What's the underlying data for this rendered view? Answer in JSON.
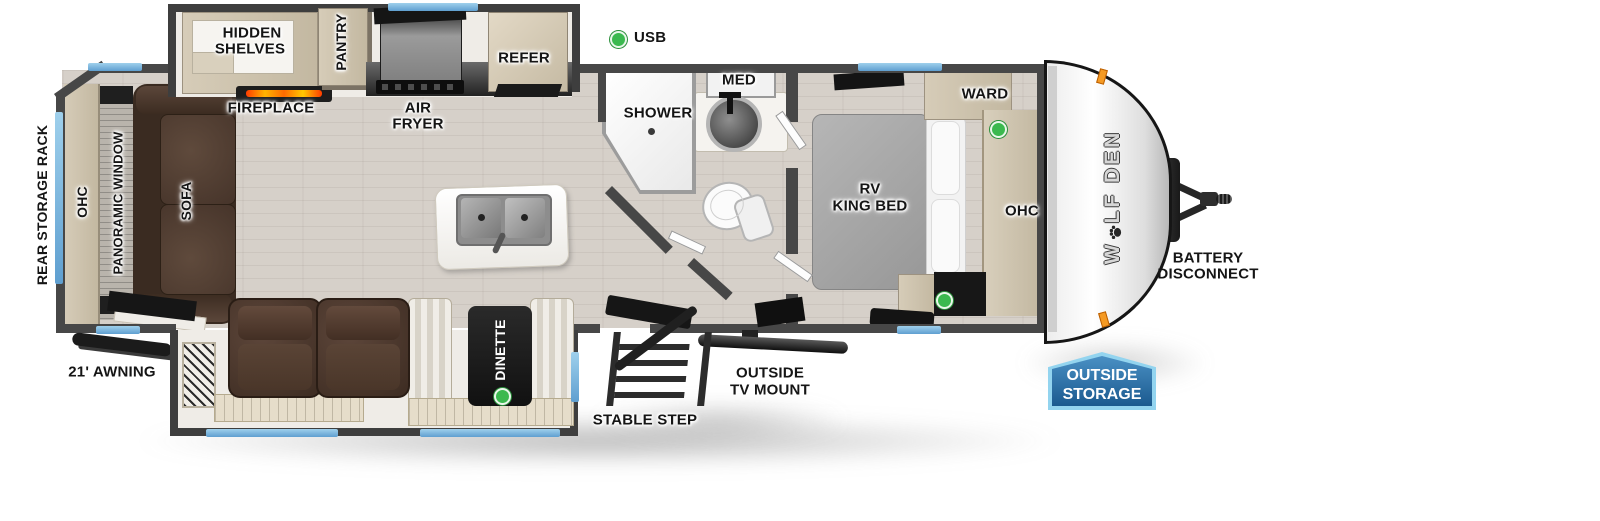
{
  "legend": {
    "usb": "USB"
  },
  "exterior": {
    "rear_storage_rack": "REAR STORAGE RACK",
    "awning": "21' AWNING",
    "stable_step": "STABLE STEP",
    "outside_tv_mount_line1": "OUTSIDE",
    "outside_tv_mount_line2": "TV MOUNT",
    "outside_storage_line1": "OUTSIDE",
    "outside_storage_line2": "STORAGE",
    "battery_line1": "BATTERY",
    "battery_line2": "DISCONNECT",
    "brand_prefix": "W",
    "brand_suffix": "LF DEN"
  },
  "kitchen": {
    "hidden_shelves_line1": "HIDDEN",
    "hidden_shelves_line2": "SHELVES",
    "pantry": "PANTRY",
    "refer": "REFER",
    "fireplace": "FIREPLACE",
    "air_fryer_line1": "AIR",
    "air_fryer_line2": "FRYER"
  },
  "living": {
    "ohc": "OHC",
    "panoramic_window": "PANORAMIC WINDOW",
    "sofa": "SOFA",
    "dinette": "DINETTE"
  },
  "bathroom": {
    "shower": "SHOWER",
    "med": "MED"
  },
  "bedroom": {
    "ward": "WARD",
    "bed_line1": "RV",
    "bed_line2": "KING BED",
    "ohc": "OHC"
  },
  "colors": {
    "wall": "#474747",
    "floor": "#d6d0c9",
    "window_blue": "#6aa8d8",
    "usb_green": "#3bb94f",
    "badge_blue": "#2f74ad",
    "badge_border": "#93d4ef",
    "sofa_brown": "#4a3629",
    "cabinet_tan": "#cdc2ae",
    "flame_orange": "#ff7a00"
  }
}
